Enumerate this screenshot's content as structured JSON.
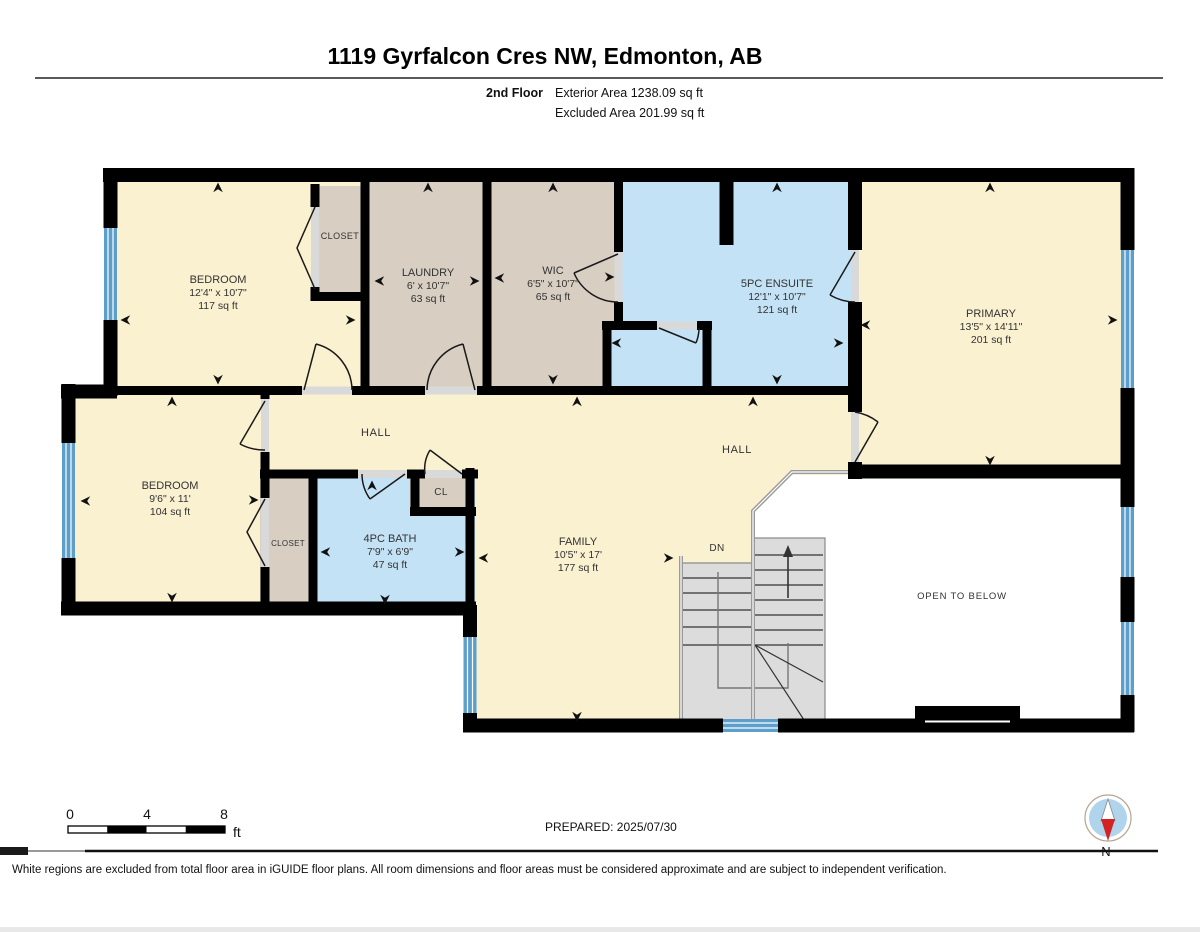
{
  "header": {
    "title": "1119 Gyrfalcon Cres NW, Edmonton, AB",
    "floor_label": "2nd Floor",
    "exterior_area": "Exterior Area 1238.09 sq ft",
    "excluded_area": "Excluded Area 201.99 sq ft"
  },
  "rooms": [
    {
      "name": "BEDROOM",
      "dims": "12'4\" x 10'7\"",
      "area": "117 sq ft"
    },
    {
      "name": "LAUNDRY",
      "dims": "6' x 10'7\"",
      "area": "63 sq ft"
    },
    {
      "name": "WIC",
      "dims": "6'5\" x 10'7\"",
      "area": "65 sq ft"
    },
    {
      "name": "5PC ENSUITE",
      "dims": "12'1\" x 10'7\"",
      "area": "121 sq ft"
    },
    {
      "name": "PRIMARY",
      "dims": "13'5\" x 14'11\"",
      "area": "201 sq ft"
    },
    {
      "name": "BEDROOM",
      "dims": "9'6\" x 11'",
      "area": "104 sq ft"
    },
    {
      "name": "4PC BATH",
      "dims": "7'9\" x 6'9\"",
      "area": "47 sq ft"
    },
    {
      "name": "FAMILY",
      "dims": "10'5\" x 17'",
      "area": "177 sq ft"
    }
  ],
  "labels": {
    "closet1": "CLOSET",
    "closet2": "CLOSET",
    "cl": "CL",
    "hall1": "HALL",
    "hall2": "HALL",
    "dn": "DN",
    "open_below": "OPEN TO BELOW"
  },
  "scale_bar": {
    "tick0": "0",
    "tick4": "4",
    "tick8": "8",
    "unit": "ft"
  },
  "footer": {
    "prepared": "PREPARED: 2025/07/30",
    "compass_label": "N",
    "disclaimer": "White regions are excluded from total floor area in iGUIDE floor plans. All room dimensions and floor areas must be considered approximate and are subject to independent verification."
  },
  "colors": {
    "cream": "#FAF1D1",
    "tan": "#D8CEC2",
    "blue": "#C4E2F6",
    "window": "#5C9FCB",
    "stair": "#DCDCDC",
    "rail": "#9A9A9A",
    "wall": "#000000",
    "compass_disc": "#AFD4EB",
    "needle_red": "#D42222"
  }
}
